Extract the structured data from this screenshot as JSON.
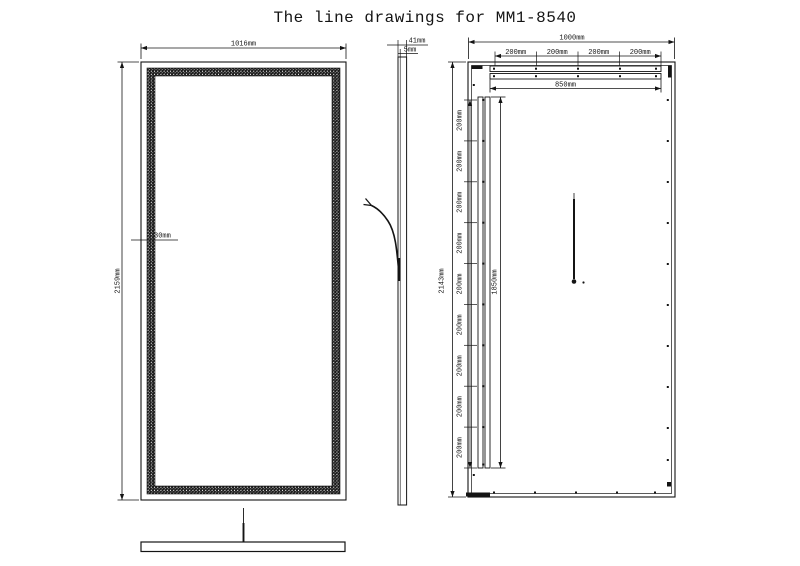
{
  "title": "The line drawings for MM1-8540",
  "colors": {
    "line": "#141414",
    "background": "#ffffff"
  },
  "front_view": {
    "width_label": "1016mm",
    "height_label": "2159mm",
    "border_label": "30mm"
  },
  "side_view": {
    "depth_label": "41mm",
    "glass_label": "5mm"
  },
  "back_view": {
    "width_label": "1000mm",
    "height_label": "2143mm",
    "rail_span_label": "850mm",
    "rail_length_label": "1850mm",
    "top_segments": [
      "200mm",
      "200mm",
      "200mm",
      "200mm"
    ],
    "left_segments": [
      "200mm",
      "200mm",
      "200mm",
      "200mm",
      "200mm",
      "200mm",
      "200mm",
      "200mm",
      "200mm"
    ]
  }
}
